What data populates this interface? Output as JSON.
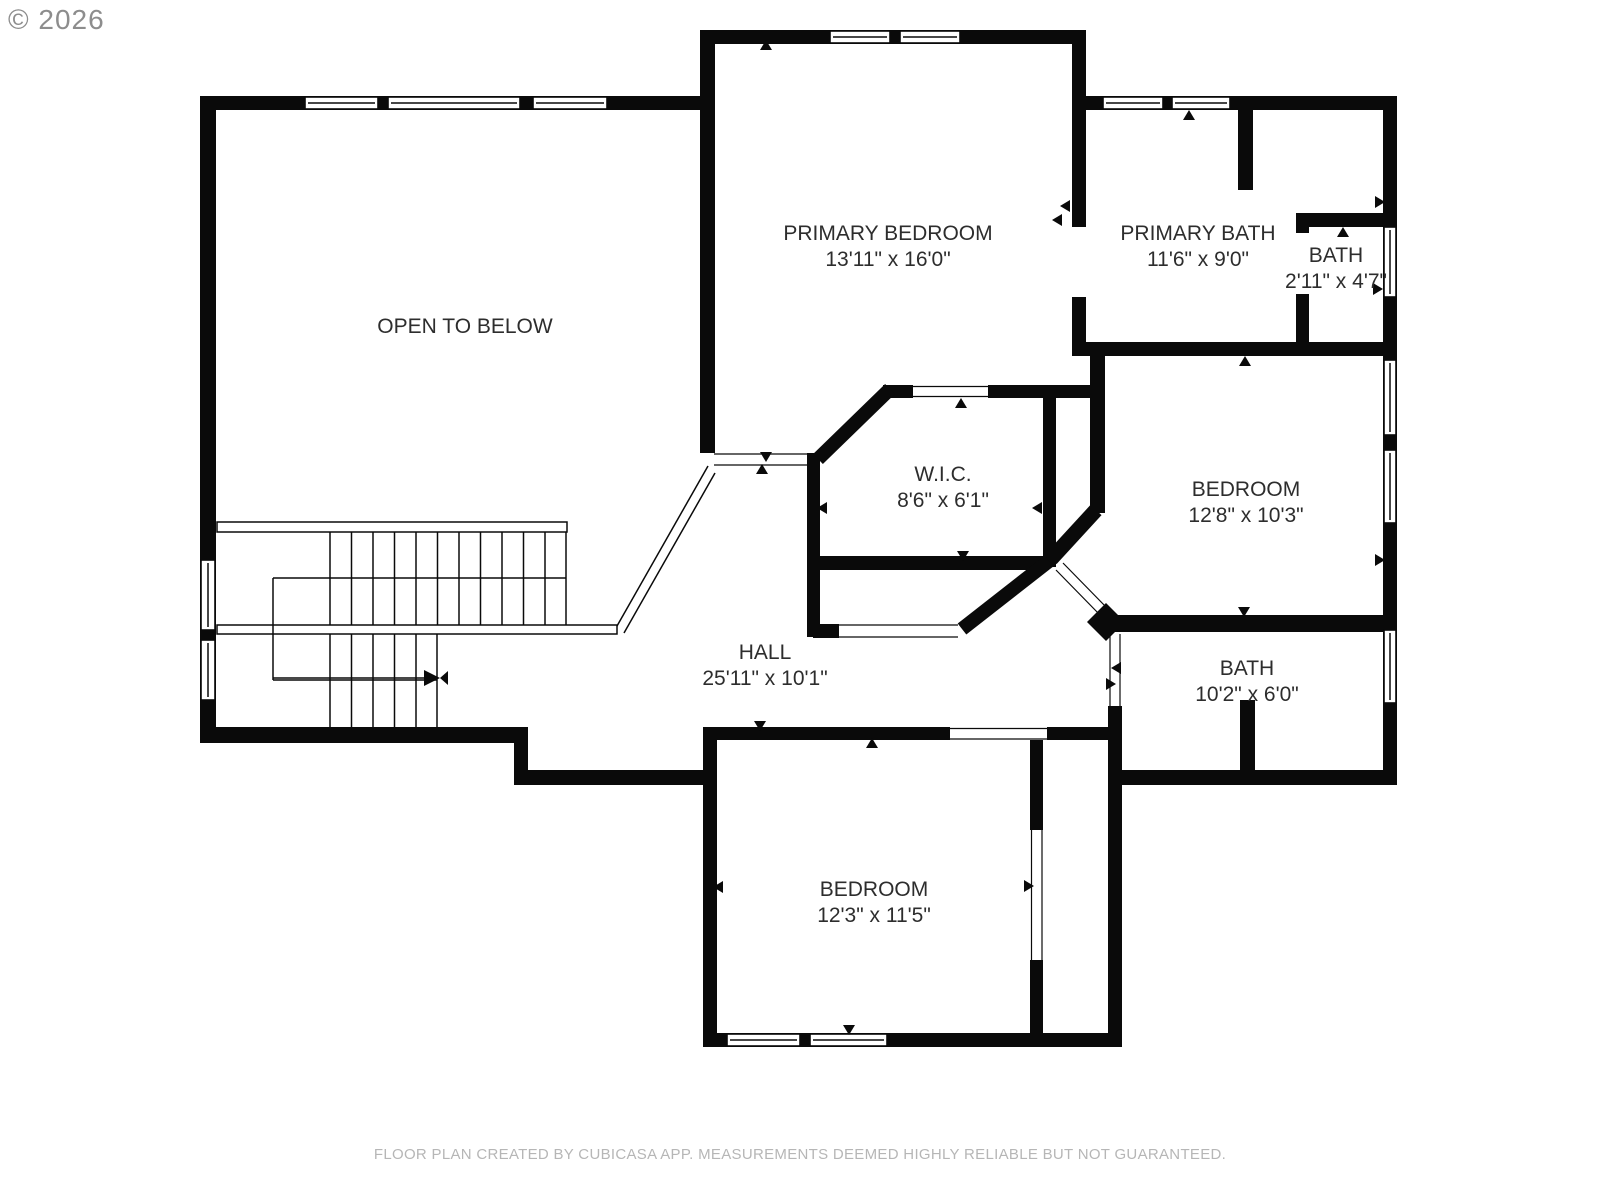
{
  "copyright": "© 2026",
  "footer": "FLOOR PLAN CREATED BY CUBICASA APP. MEASUREMENTS DEEMED HIGHLY RELIABLE BUT NOT GUARANTEED.",
  "colors": {
    "wall": "#0a0a0a",
    "label": "#2d2d2d",
    "copyright": "#8d8d8d",
    "footer": "#b6b6b6",
    "bg": "#ffffff"
  },
  "rooms": {
    "open_to_below": {
      "name": "OPEN TO BELOW",
      "dims": ""
    },
    "primary_bedroom": {
      "name": "PRIMARY BEDROOM",
      "dims": "13'11\" x 16'0\""
    },
    "primary_bath": {
      "name": "PRIMARY BATH",
      "dims": "11'6\" x 9'0\""
    },
    "bath_small": {
      "name": "BATH",
      "dims": "2'11\" x 4'7\""
    },
    "wic": {
      "name": "W.I.C.",
      "dims": "8'6\" x 6'1\""
    },
    "bedroom_right": {
      "name": "BEDROOM",
      "dims": "12'8\" x 10'3\""
    },
    "hall": {
      "name": "HALL",
      "dims": "25'11\" x 10'1\""
    },
    "bath_right": {
      "name": "BATH",
      "dims": "10'2\" x 6'0\""
    },
    "bedroom_bottom": {
      "name": "BEDROOM",
      "dims": "12'3\" x 11'5\""
    }
  }
}
